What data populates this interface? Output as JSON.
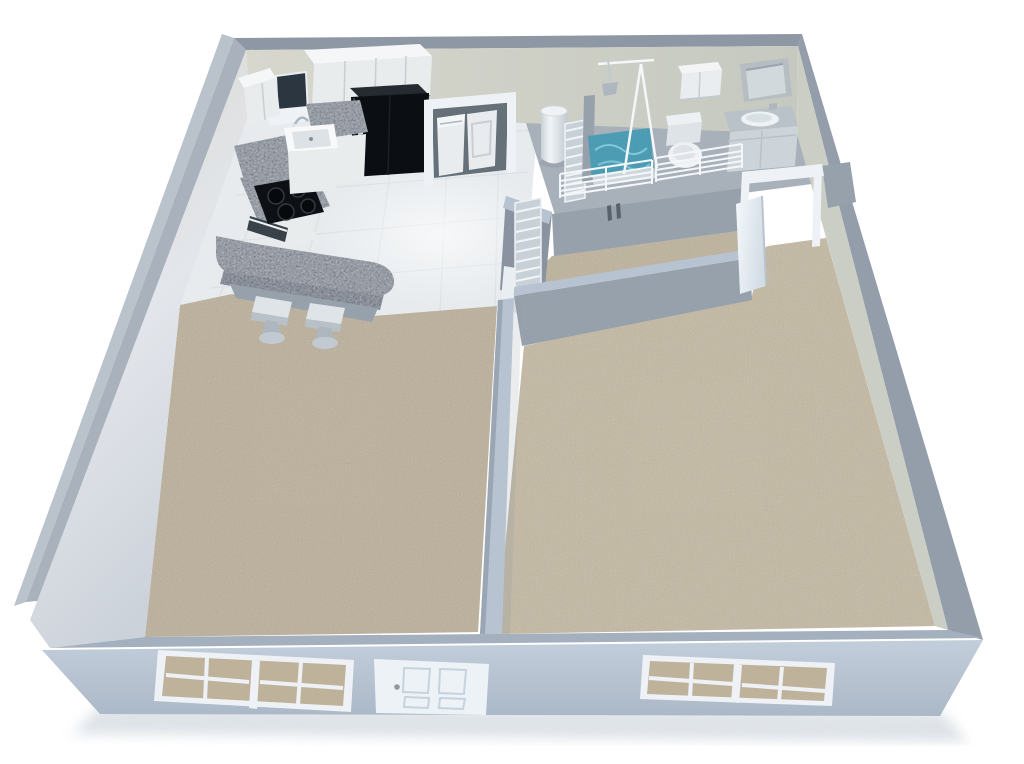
{
  "scene": {
    "label": "3D isometric cutaway floor plan render of a one-bedroom apartment",
    "view": "isometric-cutaway",
    "background": "#ffffff"
  },
  "rooms": [
    {
      "id": "kitchen",
      "label": "kitchen",
      "floor": "white tile"
    },
    {
      "id": "living-room",
      "label": "living room",
      "floor": "beige carpet"
    },
    {
      "id": "bedroom",
      "label": "bedroom",
      "floor": "beige carpet"
    },
    {
      "id": "bathroom",
      "label": "bathroom",
      "floor": "gray floor"
    },
    {
      "id": "closet",
      "label": "walk-in closet",
      "floor": "beige carpet"
    },
    {
      "id": "laundry-closet",
      "label": "laundry closet",
      "floor": "white tile"
    }
  ],
  "fixtures": {
    "kitchen": [
      "upper-cabinets",
      "kitchen-window",
      "refrigerator",
      "farm-sink",
      "faucet",
      "granite-counters",
      "cooktop",
      "oven",
      "breakfast-bar",
      "bar-stool-left",
      "bar-stool-right"
    ],
    "laundry": [
      "washer",
      "dryer",
      "door-frame"
    ],
    "utility": [
      "water-heater",
      "louvered-door-upper",
      "louvered-door-lower"
    ],
    "bathroom": [
      "shower-glass-panels",
      "shower-head",
      "shower-pan",
      "toilet",
      "medicine-cabinet",
      "vanity-with-sink",
      "wall-niche"
    ],
    "closet": [
      "wire-shelving-left",
      "wire-shelving-right",
      "wall-vents"
    ],
    "bedroom": [
      "bedroom-door",
      "bedroom-door-frame"
    ],
    "exterior": [
      "living-room-window",
      "front-door",
      "bedroom-window"
    ]
  },
  "colors": {
    "background": "#ffffff",
    "wall-top-back": "#8e98a4",
    "wall-top-left": "#a9b1bc",
    "wall-top-right": "#949eaa",
    "wall-top-front": "#a4b0be",
    "wall-back-1": "#d7d7ce",
    "wall-back-2": "#c5c9bf",
    "wall-right-face": "#cbcec5",
    "wall-left-1": "#e3e6eb",
    "wall-left-2": "#ccd2da",
    "wall-front-1": "#c3cedb",
    "wall-front-2": "#abb8c7",
    "wall-outer-left": "#b3bbc5",
    "inner-wall": "#97a1ac",
    "inner-wall-dark": "#8a939f",
    "inner-wall-top": "#b7c3d0",
    "wall-cap": "#e9eef3",
    "tile": "#e7ebee",
    "tile-line": "#d2d8dd",
    "bath-floor": "#a8b1ba",
    "carpet-living": "#bcb09a",
    "carpet-bedroom": "#c4b9a2",
    "carpet-closet": "#beb39c",
    "granite": "#8e959e",
    "granite-dark": "#7c838d",
    "cabinet": "#e9eced",
    "cabinet-top": "#f4f6f7",
    "cabinet-seam": "#c8ced3",
    "trim-white": "#eef2f6",
    "appliance-white": "#e8ecef",
    "fridge": "#0b0e12",
    "fridge-top": "#262b31",
    "laundry-interior": "#657078",
    "oven-slot": "#394149",
    "window-dark": "#2c3641",
    "glazing": "#bfb29a",
    "steel": "#aeb7bf",
    "teal": "#3f99b3",
    "teal-light": "#8fd2e2",
    "door-shadow": "#c6d2de",
    "knob": "#8f9aa6",
    "shadow": "#c3ccd5"
  }
}
